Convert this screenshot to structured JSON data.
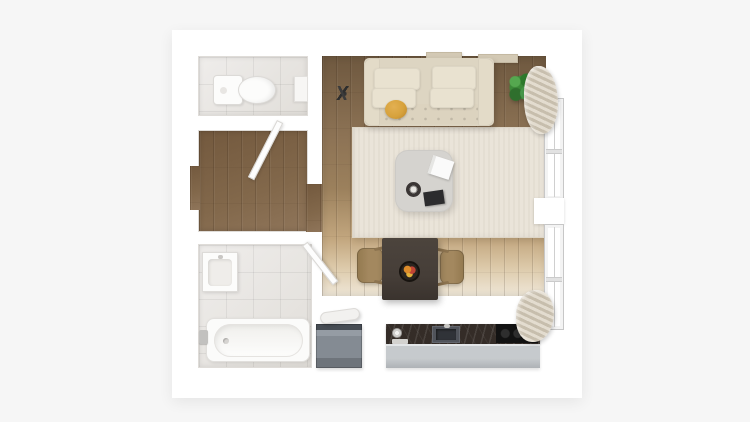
{
  "scene": {
    "kind": "apartment-floor-plan-3d-top-view",
    "rooms": [
      {
        "id": "wc",
        "floor": "tile",
        "furniture": [
          "toilet",
          "wall-cabinet"
        ]
      },
      {
        "id": "hallway",
        "floor": "wood",
        "furniture": [
          "open-door"
        ]
      },
      {
        "id": "bathroom",
        "floor": "tile",
        "furniture": [
          "washbasin",
          "bathtub",
          "tub-faucet",
          "open-door"
        ]
      },
      {
        "id": "living-room",
        "floor": "wood",
        "furniture": [
          "sofa",
          "cushions",
          "ochre-pouf",
          "rug",
          "coffee-table",
          "white-book",
          "black-book",
          "cup",
          "potted-plant",
          "dark-decor-object",
          "wall-shelves"
        ]
      },
      {
        "id": "kitchen-dining",
        "floor": "wood-to-white",
        "furniture": [
          "dining-table",
          "fruit-bowl",
          "chair-left",
          "chair-right",
          "kitchen-counter",
          "sink",
          "cooktop",
          "plate",
          "cabinet-front",
          "appliance",
          "rolled-towel"
        ]
      }
    ],
    "windows": [
      {
        "id": "window-1",
        "side": "right"
      },
      {
        "id": "window-2",
        "side": "right"
      }
    ],
    "curtains": [
      {
        "id": "curtain-top"
      },
      {
        "id": "curtain-bottom"
      }
    ]
  },
  "colors": {
    "bg": "#f6f6f6",
    "plan": "#ffffff",
    "tile": "#eae8e5",
    "wood_dark": "#6e583f",
    "wood_mid": "#8d7355",
    "wood_light": "#efe7d8",
    "hall_wood": "#82684b",
    "rug": "#eae4d9",
    "sofa": "#ddd5c2",
    "sofa_arm": "#e3dbc8",
    "cushion": "#e9e2d0",
    "pouf": "#d7a23c",
    "coffee_table": "#d5d3cf",
    "book_white": "#fafafa",
    "book_black": "#2c2c2e",
    "dining_table": "#463e38",
    "chair": "#a3885f",
    "counter": "#342c27",
    "cabinet": "#c6cacd",
    "cooktop": "#121212",
    "appliance": "#878e96",
    "plant": "#3c8a38",
    "curtain": "#d5cdbf",
    "door": "#fdfdfd",
    "fixture": "#fcfcfb",
    "wall_line": "#dfdcd8"
  }
}
